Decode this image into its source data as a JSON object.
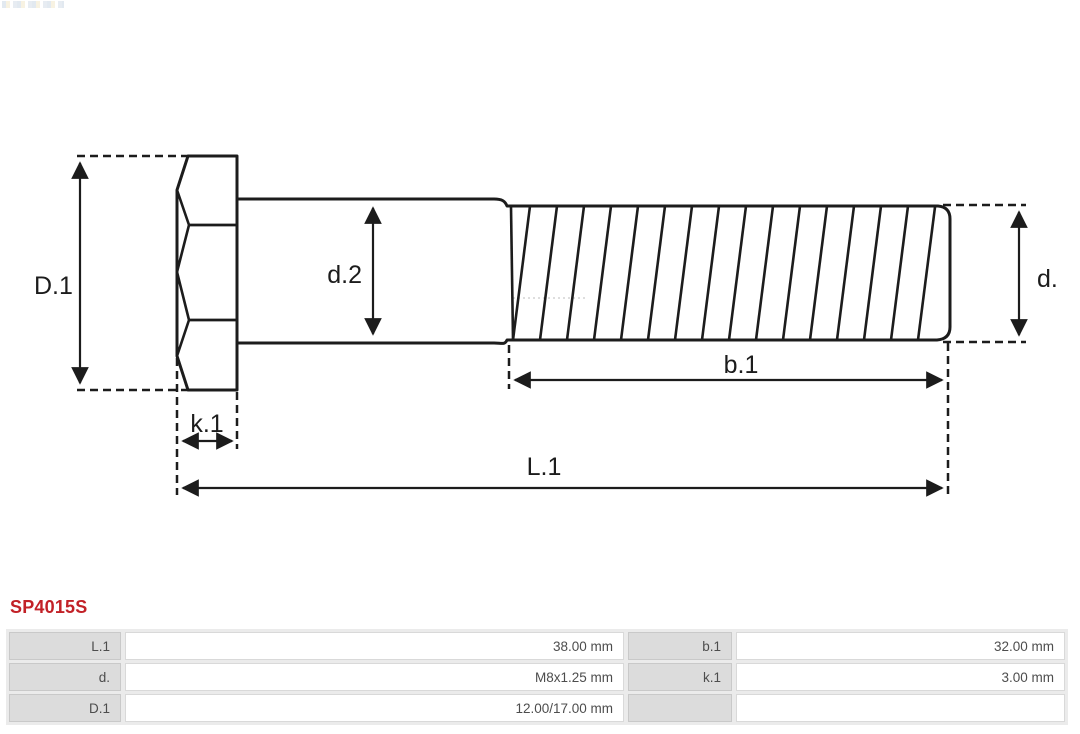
{
  "product": {
    "code": "SP4015S"
  },
  "diagram": {
    "type": "bolt technical drawing, side view with dimension callouts",
    "labels": {
      "D1": "D.1",
      "d2": "d.2",
      "d": "d.",
      "k1": "k.1",
      "b1": "b.1",
      "L1": "L.1"
    }
  },
  "spec_table": {
    "rows": [
      {
        "l_label": "L.1",
        "l_value": "38.00 mm",
        "r_label": "b.1",
        "r_value": "32.00 mm"
      },
      {
        "l_label": "d.",
        "l_value": "M8x1.25 mm",
        "r_label": "k.1",
        "r_value": "3.00 mm"
      },
      {
        "l_label": "D.1",
        "l_value": "12.00/17.00 mm",
        "r_label": "",
        "r_value": ""
      }
    ]
  },
  "colors": {
    "accent_red": "#c22127",
    "drawing_line": "#1c1c1c",
    "table_header_gray": "#dcdcdc",
    "table_frame_gray": "#ebebeb",
    "table_text_gray": "#4d4d4d"
  }
}
